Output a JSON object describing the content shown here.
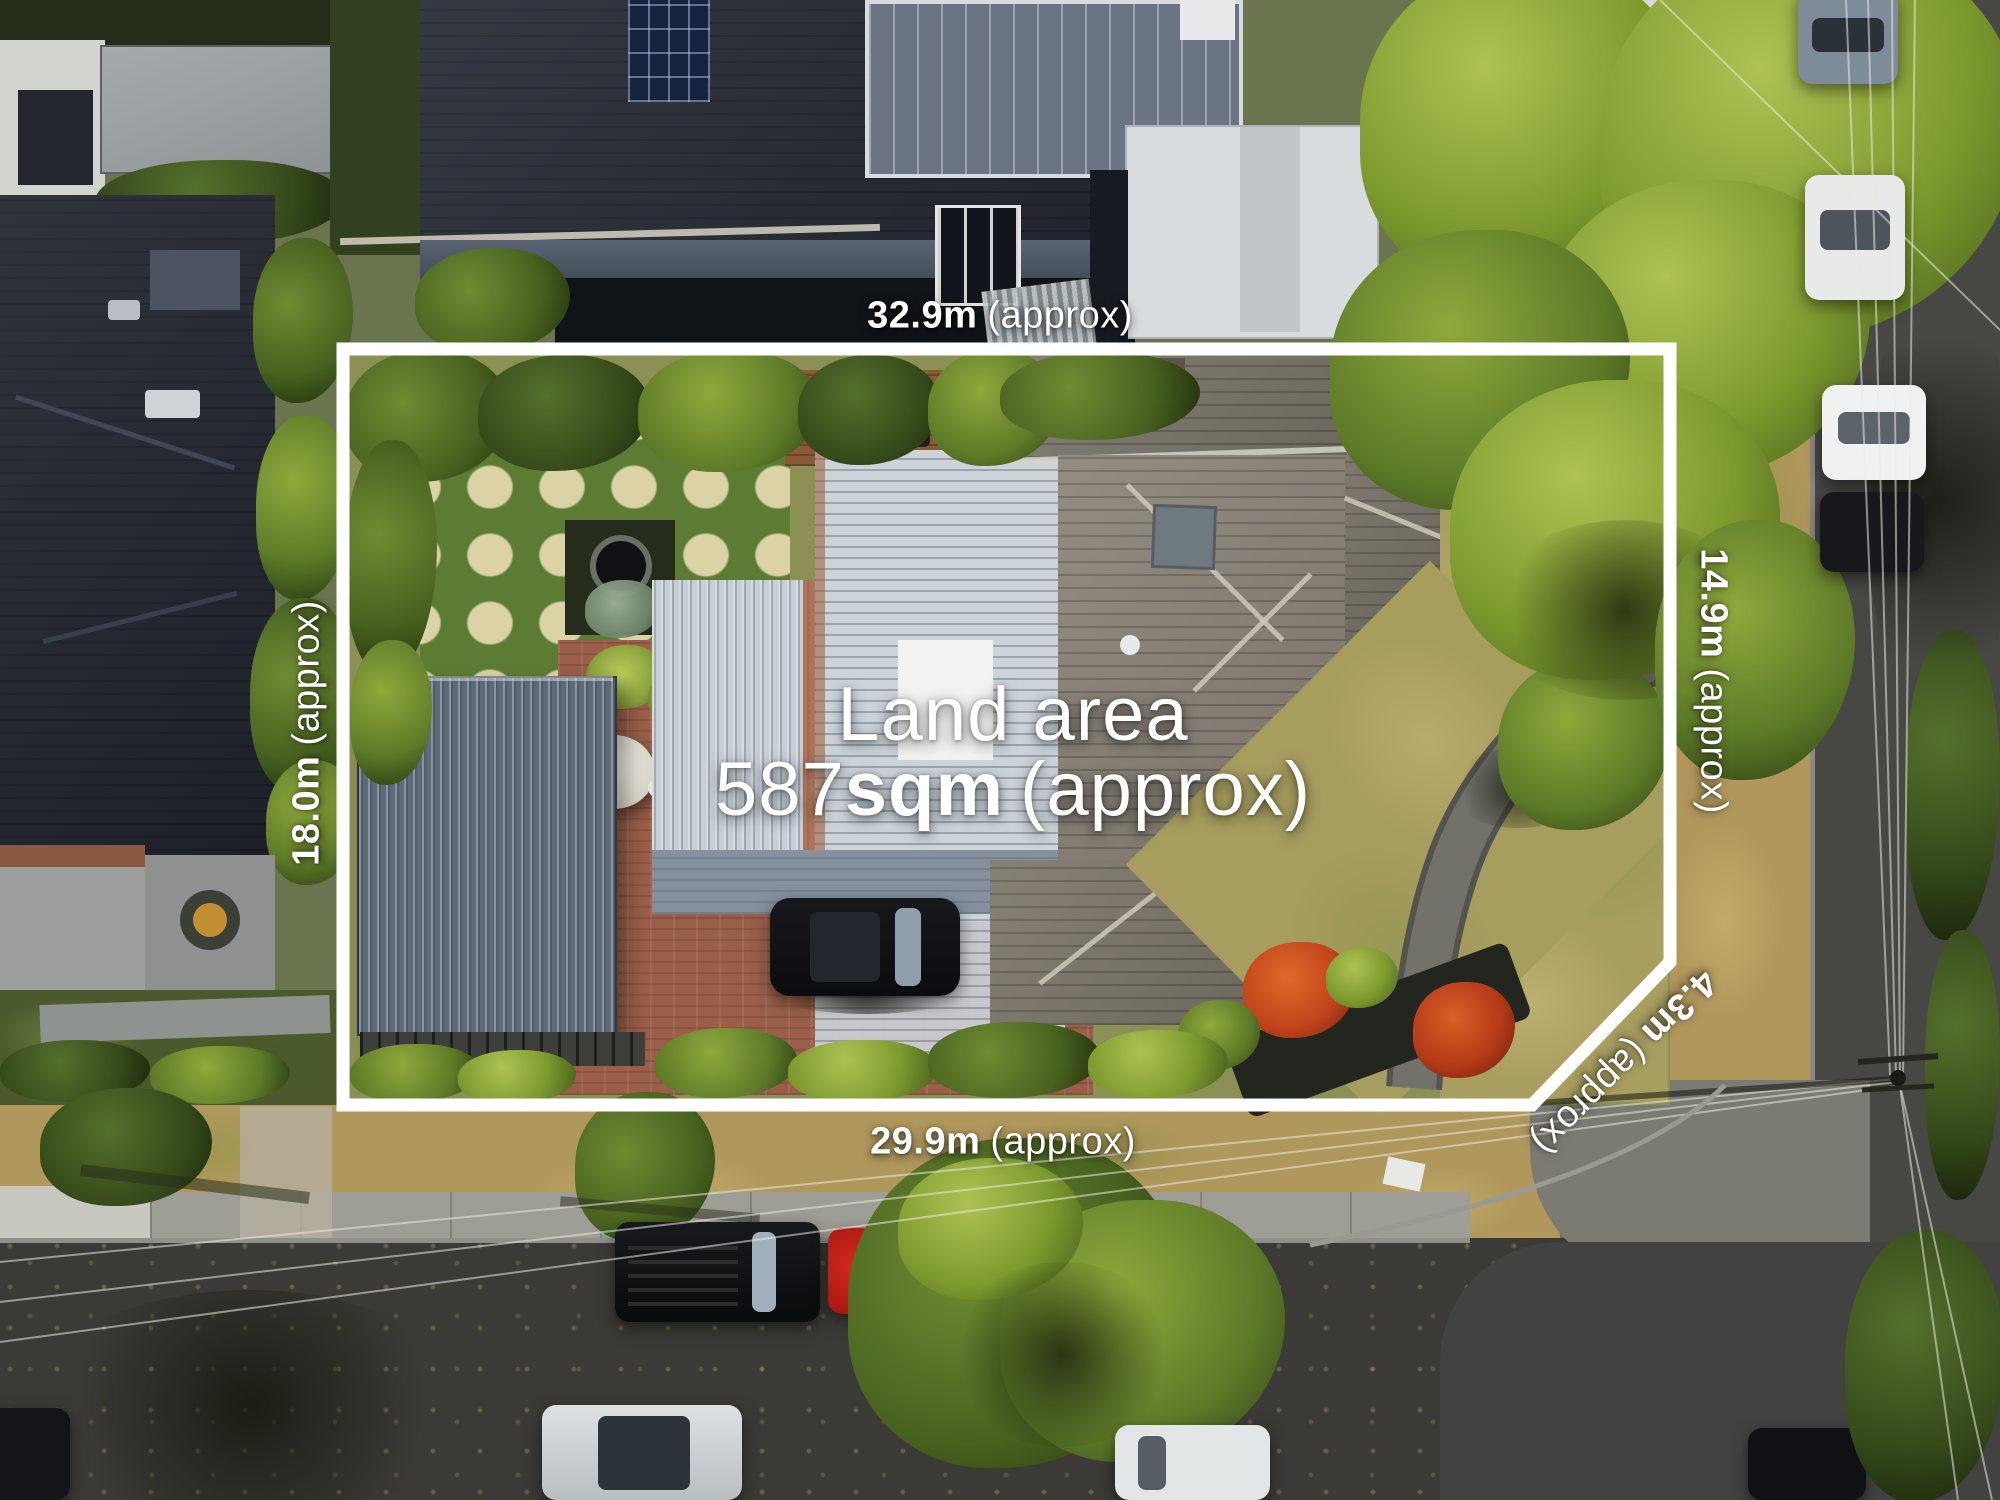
{
  "scene": {
    "description": "Aerial drone photograph of a residential property marked with a white land boundary outline and dimension annotations"
  },
  "labels": {
    "land_area": {
      "line1": "Land area",
      "value": "587",
      "unit": "sqm",
      "suffix": "(approx)"
    },
    "dim_top": {
      "value": "32.9m",
      "suffix": "(approx)"
    },
    "dim_bottom": {
      "value": "29.9m",
      "suffix": "(approx)"
    },
    "dim_left": {
      "value": "18.0m",
      "suffix": "(approx)"
    },
    "dim_right": {
      "value": "14.9m",
      "suffix": "(approx)"
    },
    "dim_corner": {
      "value": "4.3m",
      "suffix": "(approx)"
    }
  },
  "colors": {
    "boundary_line": "#ffffff",
    "label_text": "#ffffff",
    "asphalt": "#3b3a36",
    "tile_roof": "#8b8478",
    "metal_roof_white": "#ccd4da",
    "garage_roof": "#5d6a7a",
    "lawn_dry": "#a89e60",
    "tree_green": "#7d9a2e",
    "brick_paving": "#9a5e49"
  }
}
